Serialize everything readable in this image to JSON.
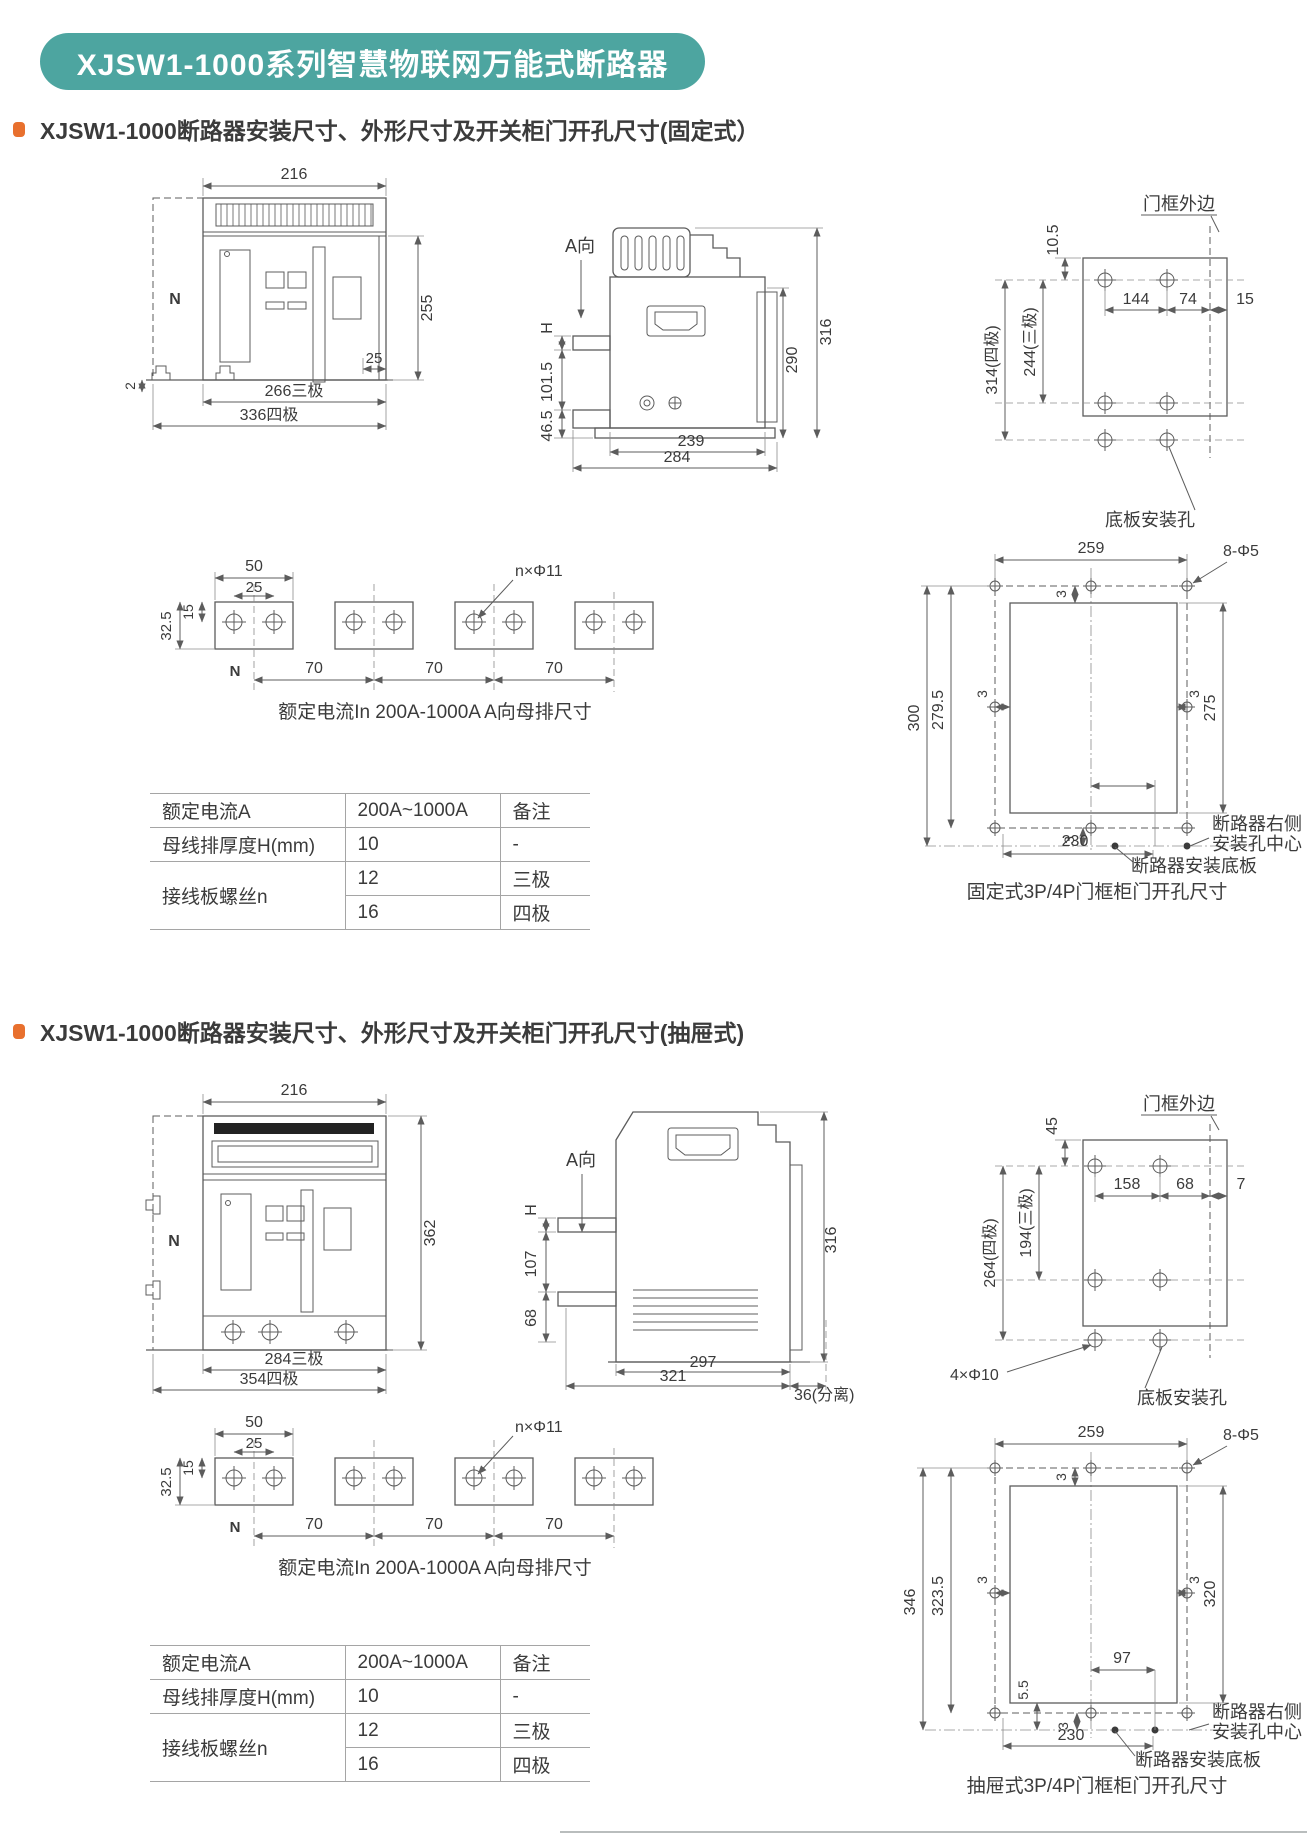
{
  "banner": {
    "title": "XJSW1-1000系列智慧物联网万能式断路器",
    "bg_color": "#4da5a0",
    "bullet_color": "#e8702e"
  },
  "s1": {
    "heading": "XJSW1-1000断路器安装尺寸、外形尺寸及开关柜门开孔尺寸(固定式）",
    "front": {
      "w": "216",
      "h": "255",
      "edge": "25",
      "base": "2",
      "p3": "266三极",
      "p4": "336四极",
      "n": "N"
    },
    "side": {
      "a": "A向",
      "h": "H",
      "d1": "101.5",
      "d2": "46.5",
      "d3": "290",
      "d4": "316",
      "d5": "239",
      "d6": "284"
    },
    "frame": {
      "edge": "门框外边",
      "d1": "10.5",
      "d2": "144",
      "d3": "74",
      "d4": "15",
      "d5": "314(四极)",
      "d6": "244(三极)",
      "holes": "底板安装孔"
    },
    "bus": {
      "d1": "50",
      "d2": "25",
      "d3": "15",
      "d4": "32.5",
      "hole": "n×Φ11",
      "p": "70",
      "n": "N",
      "caption": "额定电流In 200A-1000A   A向母排尺寸"
    },
    "cut": {
      "w": "259",
      "o": "3",
      "hole": "8-Φ5",
      "d1": "300",
      "d2": "279.5",
      "d3": "275",
      "d4": "230",
      "r1": "断路器右侧",
      "r2": "安装孔中心",
      "plate": "断路器安装底板",
      "caption": "固定式3P/4P门框柜门开孔尺寸"
    },
    "table": {
      "r1c1": "额定电流A",
      "r1c2": "200A~1000A",
      "r1c3": "备注",
      "r2c1": "母线排厚度H(mm)",
      "r2c2": "10",
      "r2c3": "-",
      "r3c1": "接线板螺丝n",
      "r3c2": "12",
      "r3c3": "三极",
      "r4c2": "16",
      "r4c3": "四极"
    }
  },
  "s2": {
    "heading": "XJSW1-1000断路器安装尺寸、外形尺寸及开关柜门开孔尺寸(抽屉式)",
    "front": {
      "w": "216",
      "h": "362",
      "p3": "284三极",
      "p4": "354四极",
      "n": "N"
    },
    "side": {
      "a": "A向",
      "h": "H",
      "d1": "107",
      "d2": "68",
      "d3": "316",
      "d4": "297",
      "d5": "321",
      "d6": "36(分离)"
    },
    "frame": {
      "edge": "门框外边",
      "d1": "45",
      "d2": "158",
      "d3": "68",
      "d4": "7",
      "d5": "264(四极)",
      "d6": "194(三极)",
      "holes4": "4×Φ10",
      "holes": "底板安装孔"
    },
    "bus": {
      "d1": "50",
      "d2": "25",
      "d3": "15",
      "d4": "32.5",
      "hole": "n×Φ11",
      "p": "70",
      "n": "N",
      "caption": "额定电流In 200A-1000A   A向母排尺寸"
    },
    "cut": {
      "w": "259",
      "o": "3",
      "hole": "8-Φ5",
      "d1": "346",
      "d2": "323.5",
      "d3": "320",
      "d5": "5.5",
      "d6": "97",
      "d4": "230",
      "r1": "断路器右侧",
      "r2": "安装孔中心",
      "plate": "断路器安装底板",
      "caption": "抽屉式3P/4P门框柜门开孔尺寸"
    },
    "table": {
      "r1c1": "额定电流A",
      "r1c2": "200A~1000A",
      "r1c3": "备注",
      "r2c1": "母线排厚度H(mm)",
      "r2c2": "10",
      "r2c3": "-",
      "r3c1": "接线板螺丝n",
      "r3c2": "12",
      "r3c3": "三极",
      "r4c2": "16",
      "r4c3": "四极"
    }
  }
}
